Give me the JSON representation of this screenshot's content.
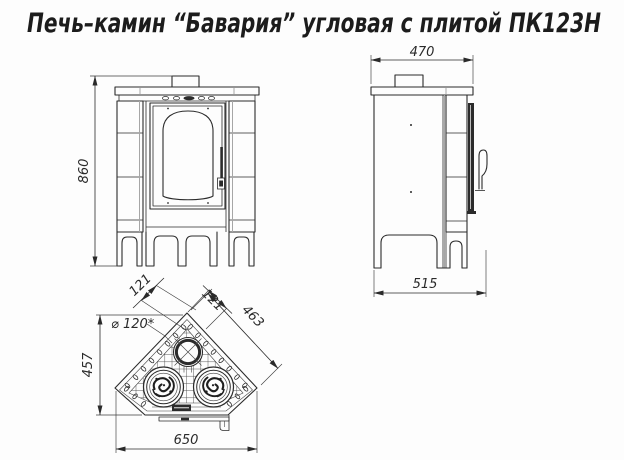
{
  "title": "Печь–камин “Бавария” угловая с плитой ПК123Н",
  "drawing": {
    "front_view": {
      "name": "front view",
      "dim_height": "860"
    },
    "side_view": {
      "name": "side view",
      "dim_top_width": "470",
      "dim_bottom_depth": "515"
    },
    "top_view": {
      "name": "top plan view",
      "dim_left_offset": "121",
      "dim_right_offset": "121",
      "dim_back_edge": "463",
      "dim_depth": "457",
      "dim_width": "650",
      "dim_flue": "⌀ 120*"
    }
  },
  "colors": {
    "line": "#2b2b2b",
    "dimension": "#2a2a2a",
    "background": "#fdfdfd"
  }
}
